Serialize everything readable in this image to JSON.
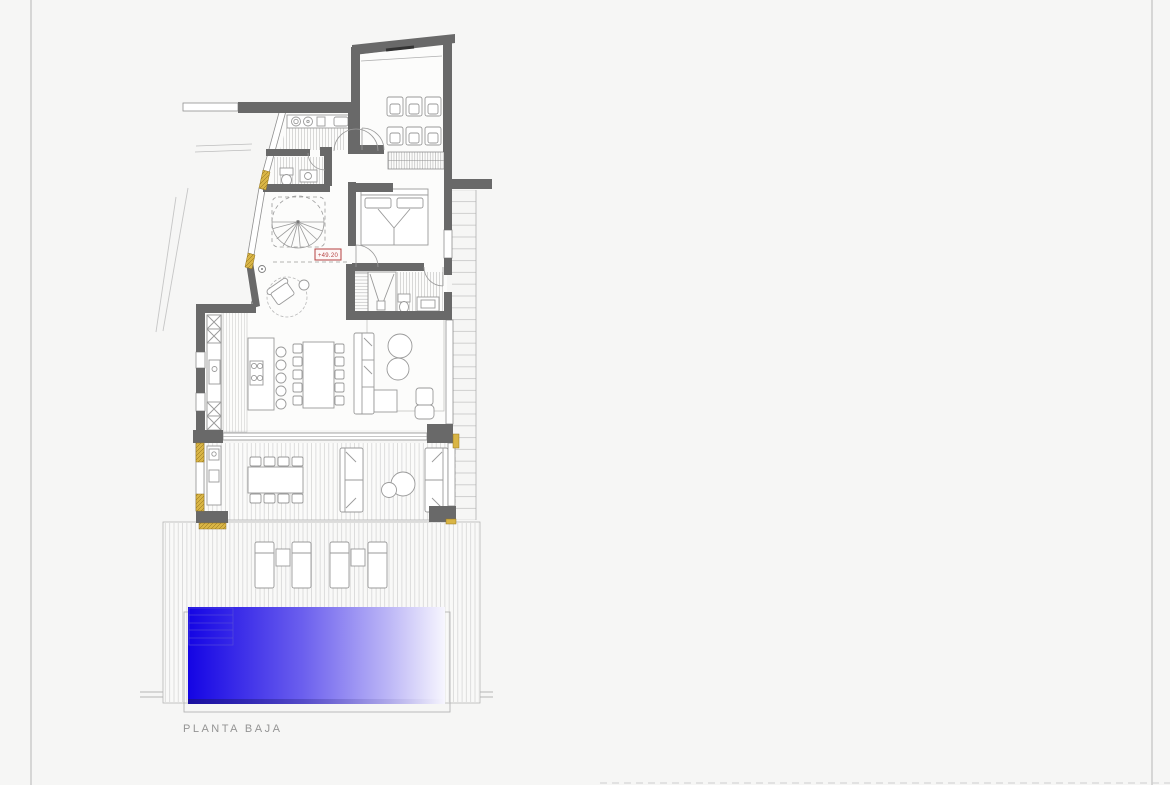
{
  "drawing": {
    "title": "PLANTA BAJA",
    "level_marker": "+49.20",
    "colors": {
      "background": "#f6f6f5",
      "frame_line": "#c0c0c0",
      "wall": "#696969",
      "detail_line": "#9a9a9a",
      "hatch_line": "#c0c0c0",
      "deck_line": "#d6d6d6",
      "wood_accent": "#d9b545",
      "marker_red": "#b54040",
      "title_gray": "#949494",
      "pool_blue_start": "#1404e4",
      "pool_blue_mid": "#6c60ee",
      "pool_blue_end": "#f7f6fe",
      "pool_step_line": "#5a52d6"
    },
    "features": [
      "cinema-room",
      "wardrobe",
      "bedroom",
      "ensuite-bathroom",
      "guest-bathroom",
      "utility-room",
      "spiral-staircase",
      "entry-hall",
      "kitchen-island",
      "dining-table",
      "living-sofa",
      "covered-terrace",
      "outdoor-dining",
      "outdoor-sofas",
      "sun-deck",
      "sun-loungers",
      "swimming-pool",
      "pool-steps",
      "exterior-steps"
    ]
  }
}
